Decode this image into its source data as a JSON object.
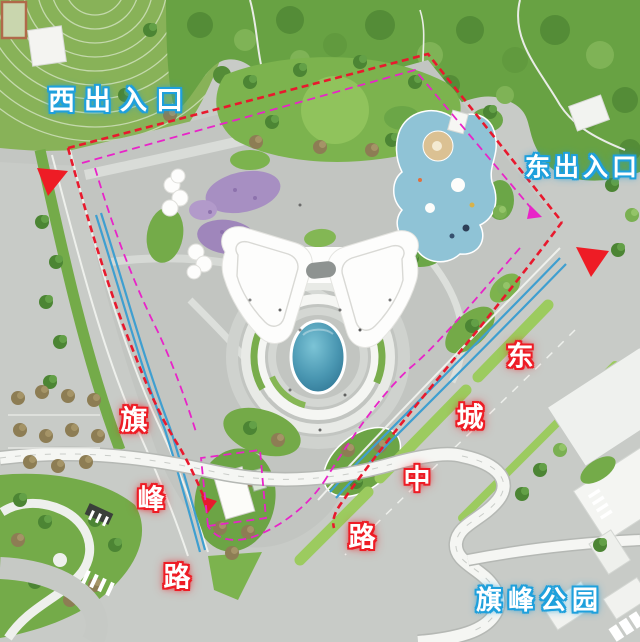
{
  "labels": {
    "west_entrance": "西出入口",
    "east_entrance": "东出入口",
    "qifeng_park": "旗峰公园"
  },
  "roads": {
    "qifeng_road": {
      "name": "旗峰路",
      "chars": [
        "旗",
        "峰",
        "路"
      ]
    },
    "dongcheng_middle_road": {
      "name": "东城中路",
      "chars": [
        "东",
        "城",
        "中",
        "路"
      ]
    }
  },
  "markers": {
    "west_entrance_arrow": "red-triangle",
    "east_entrance_arrow": "red-triangle"
  },
  "colors": {
    "label-blue": "#1fa0dc",
    "label-red": "#ee1c25",
    "boundary-red": "#e8192d",
    "boundary-magenta": "#e824c8",
    "marker-red": "#ee1c25",
    "pond-blue": "#3a89a8",
    "playground-blue": "#8fc3d6",
    "lawn-green": "#7cb34e",
    "flower-purple": "#a78fc2",
    "bus-lane-blue": "#3f9fd0"
  }
}
